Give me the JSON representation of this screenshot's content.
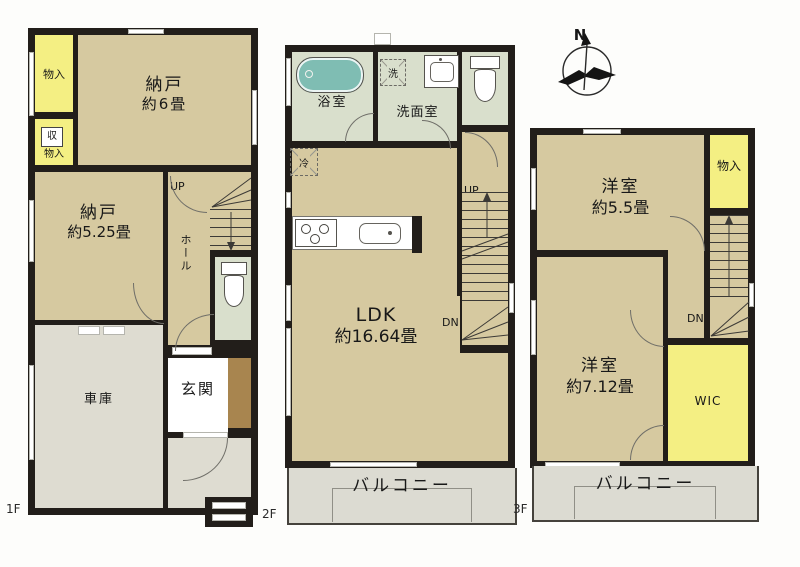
{
  "compass": {
    "north": "N"
  },
  "colors": {
    "wall": "#221e1a",
    "room": "#d6c9a0",
    "storage_yellow": "#f4ef83",
    "wet": "#d9dfcc",
    "garage_gray": "#dedcd1",
    "balcony_gray": "#dcdbd2",
    "tub_teal": "#7fbdb3",
    "step_brown": "#a8854f"
  },
  "floor1": {
    "floor_label": "1F",
    "storage_top": "物入",
    "closet_box": "収",
    "closet_label": "物入",
    "nando6_name": "納戸",
    "nando6_size": "約6畳",
    "nando525_name": "納戸",
    "nando525_size": "約5.25畳",
    "hall": "ホール",
    "up": "UP",
    "entrance": "玄関",
    "garage": "車庫"
  },
  "floor2": {
    "floor_label": "2F",
    "bath": "浴室",
    "laundry": "洗",
    "washroom": "洗面室",
    "fridge": "冷",
    "ldk_name": "LDK",
    "ldk_size": "約16.64畳",
    "up": "UP",
    "dn": "DN",
    "balcony": "バルコニー"
  },
  "floor3": {
    "floor_label": "3F",
    "room55_name": "洋室",
    "room55_size": "約5.5畳",
    "storage": "物入",
    "room712_name": "洋室",
    "room712_size": "約7.12畳",
    "wic": "WIC",
    "dn": "DN",
    "balcony": "バルコニー"
  }
}
